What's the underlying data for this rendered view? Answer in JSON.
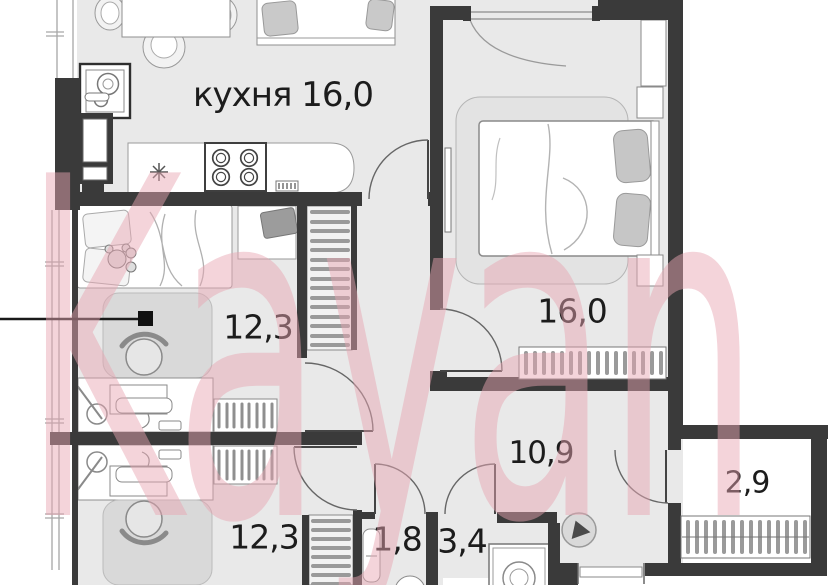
{
  "watermark": {
    "text": "Kayan",
    "color": "#eaa6b2"
  },
  "colors": {
    "wall": "#3a3a3a",
    "floor": "#e9e9e9",
    "furniture_outline": "#8f8f8f",
    "label": "#1c1c1c"
  },
  "rooms": [
    {
      "id": "kitchen-living-room",
      "label": "кухня 16,0"
    },
    {
      "id": "bedroom",
      "label": "16,0"
    },
    {
      "id": "room-middle-left",
      "label": "12,3"
    },
    {
      "id": "room-bottom-left",
      "label": "12,3"
    },
    {
      "id": "hallway",
      "label": "10,9"
    },
    {
      "id": "balcony",
      "label": "2,9"
    },
    {
      "id": "storage",
      "label": "1,8"
    },
    {
      "id": "bathroom",
      "label": "3,4"
    }
  ]
}
